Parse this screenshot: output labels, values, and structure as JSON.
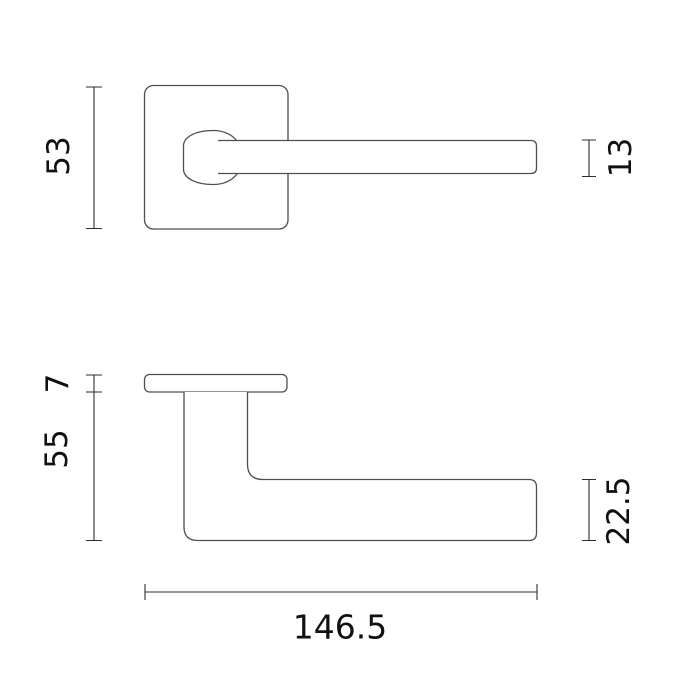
{
  "drawing": {
    "subject": "door-handle-technical-drawing",
    "colors": {
      "background": "#ffffff",
      "object_outline": "#4f4f4f",
      "dimension_line": "#2e2e2e",
      "label_text": "#111111"
    },
    "front_view": {
      "dims": {
        "rosette_height": "53",
        "lever_thickness": "13"
      }
    },
    "side_view": {
      "dims": {
        "rosette_depth": "7",
        "projection": "55",
        "grip_height": "22.5",
        "overall_length": "146.5"
      }
    }
  }
}
